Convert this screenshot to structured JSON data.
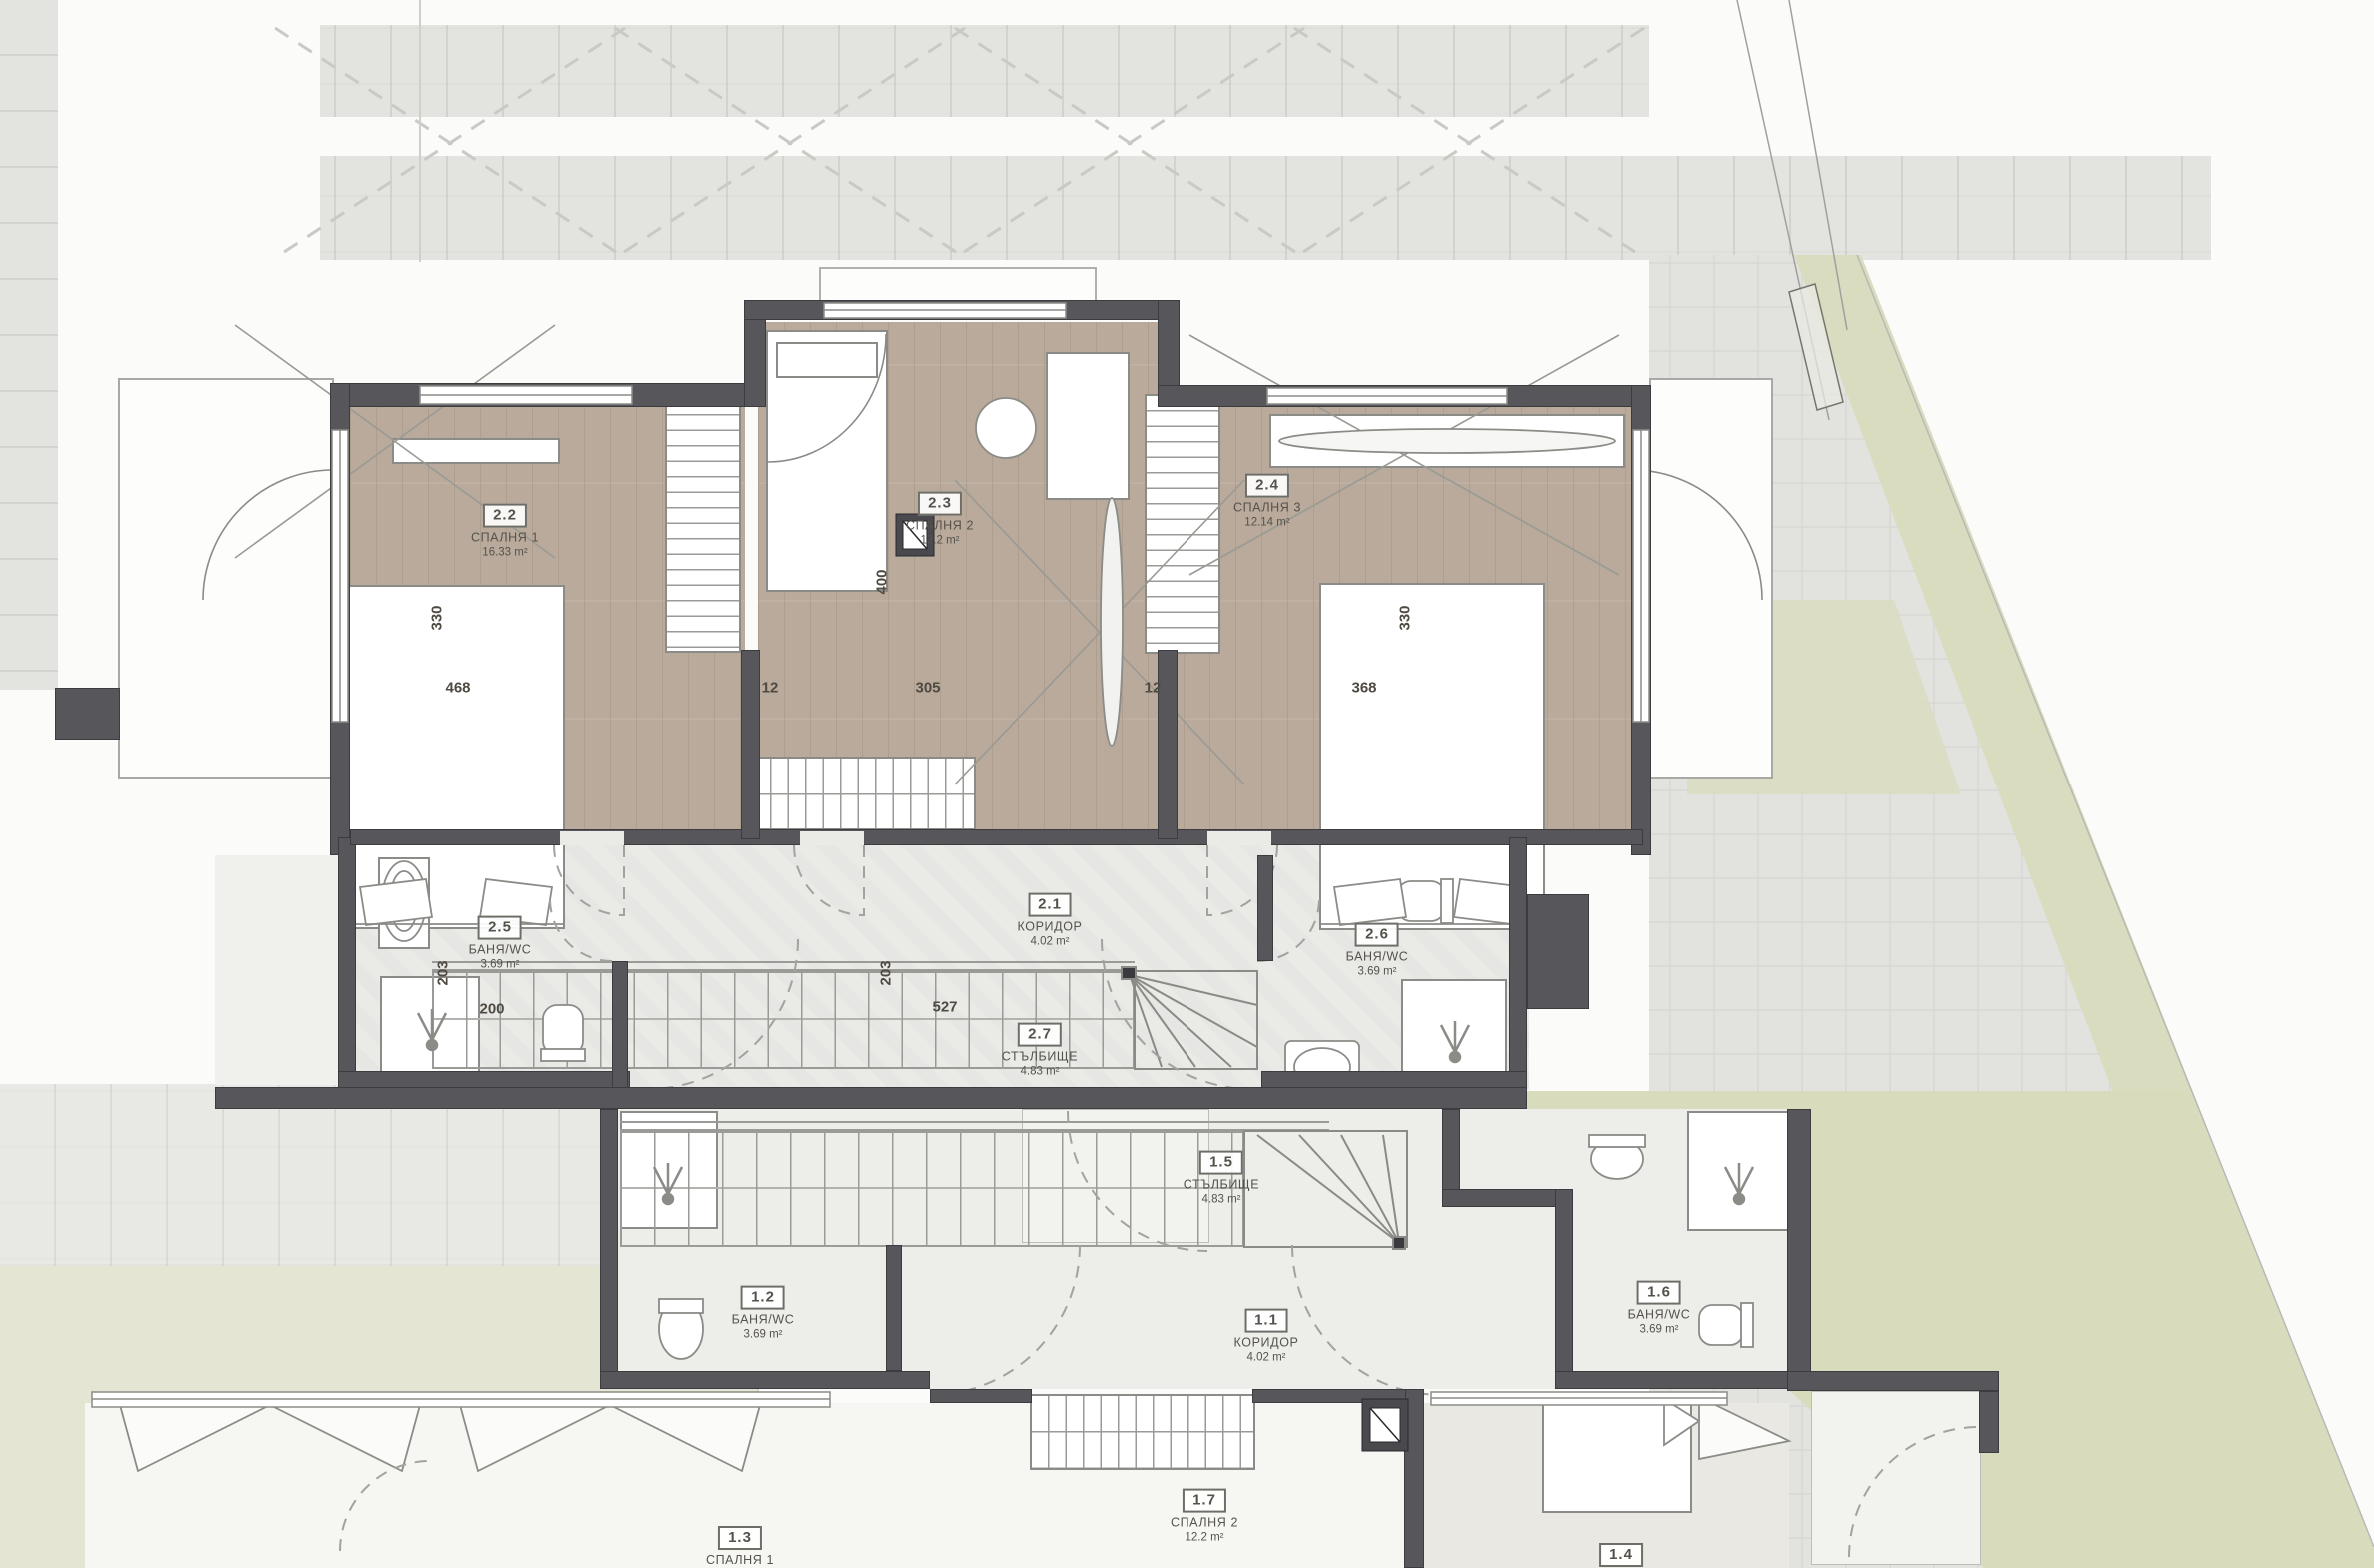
{
  "plan": {
    "type": "architectural-floor-plan",
    "levels": "two mirrored maisonette units (rooms 2.x upper unit, 1.x lower unit)"
  },
  "rooms": {
    "r21": {
      "num": "2.1",
      "name": "КОРИДОР",
      "area": "4.02 m²"
    },
    "r22": {
      "num": "2.2",
      "name": "СПАЛНЯ 1",
      "area": "16.33 m²"
    },
    "r23": {
      "num": "2.3",
      "name": "СПАЛНЯ 2",
      "area": "12.2 m²"
    },
    "r24": {
      "num": "2.4",
      "name": "СПАЛНЯ 3",
      "area": "12.14 m²"
    },
    "r25": {
      "num": "2.5",
      "name": "БАНЯ/WC",
      "area": "3.69 m²"
    },
    "r26": {
      "num": "2.6",
      "name": "БАНЯ/WC",
      "area": "3.69 m²"
    },
    "r27": {
      "num": "2.7",
      "name": "СТЪЛБИЩЕ",
      "area": "4.83 m²"
    },
    "r11": {
      "num": "1.1",
      "name": "КОРИДОР",
      "area": "4.02 m²"
    },
    "r12": {
      "num": "1.2",
      "name": "БАНЯ/WC",
      "area": "3.69 m²"
    },
    "r13": {
      "num": "1.3",
      "name": "СПАЛНЯ 1"
    },
    "r14": {
      "num": "1.4"
    },
    "r15": {
      "num": "1.5",
      "name": "СТЪЛБИЩЕ",
      "area": "4.83 m²"
    },
    "r16": {
      "num": "1.6",
      "name": "БАНЯ/WC",
      "area": "3.69 m²"
    },
    "r17": {
      "num": "1.7",
      "name": "СПАЛНЯ 2",
      "area": "12.2 m²"
    }
  },
  "dimensions": {
    "bed1_width": "330",
    "bed1_length": "468",
    "room23_depth": "400",
    "room23_width": "305",
    "wall_left": "12",
    "wall_right": "12",
    "bed3_length": "368",
    "bed3_width": "330",
    "stair_length": "527",
    "stair_width": "203",
    "bath_depth": "203",
    "bath_width": "200"
  },
  "colors": {
    "wall": "#57575b",
    "wood_floor": "#b9aa9b",
    "stone_floor": "#eaeae7",
    "paving": "#e3e3df",
    "lawn": "#d9dcc0",
    "terrace": "#fdfdfc",
    "fixture_line": "#8b8b87",
    "text": "#55524c"
  }
}
